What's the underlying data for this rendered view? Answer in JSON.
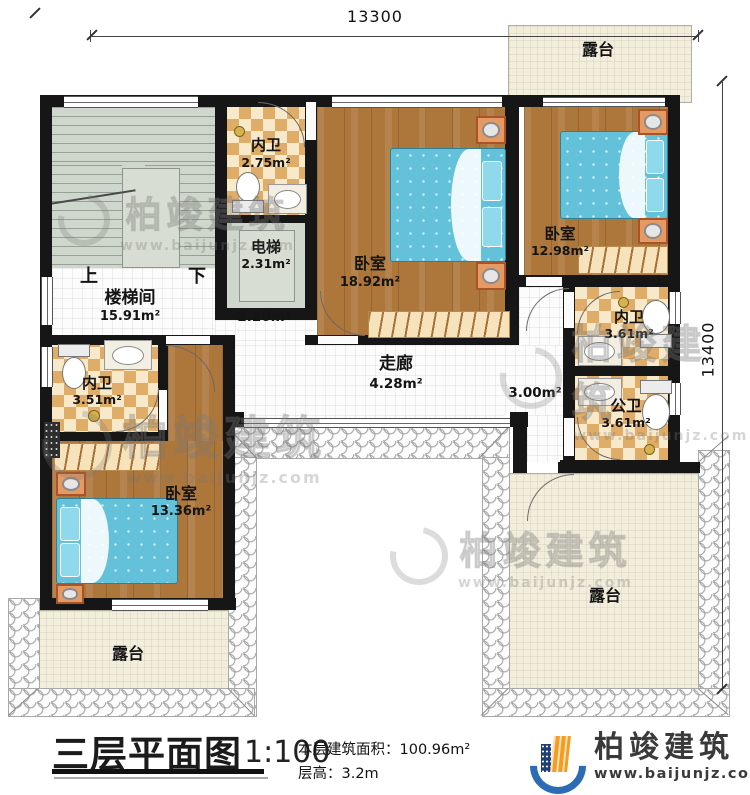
{
  "dimensions": {
    "top": "13300",
    "right": "13400"
  },
  "rooms": {
    "terrace_top": {
      "label": "露台"
    },
    "bath_top": {
      "label": "内卫",
      "area": "2.75m²"
    },
    "elevator": {
      "label": "电梯",
      "area": "2.31m²"
    },
    "bedroom_main": {
      "label": "卧室",
      "area": "18.92m²"
    },
    "bedroom_right": {
      "label": "卧室",
      "area": "12.98m²"
    },
    "stairwell": {
      "label": "楼梯间",
      "area": "15.91m²",
      "up": "上",
      "down": "下",
      "landing_area": "2.20m²"
    },
    "bath_right": {
      "label": "内卫",
      "area": "3.61m²"
    },
    "bath_public": {
      "label": "公卫",
      "area": "3.61m²"
    },
    "bath_left": {
      "label": "内卫",
      "area": "3.51m²"
    },
    "bedroom_left": {
      "label": "卧室",
      "area": "13.36m²"
    },
    "corridor": {
      "label": "走廊",
      "area": "4.28m²",
      "passage_area": "3.00m²"
    },
    "terrace_bottom_left": {
      "label": "露台"
    },
    "terrace_bottom_right": {
      "label": "露台"
    }
  },
  "title": {
    "name": "三层平面图",
    "scale": "1:100",
    "floor_area_label": "本层建筑面积：",
    "floor_area": "100.96m²",
    "height_label": "层高：",
    "height": "3.2m"
  },
  "brand": {
    "name": "柏竣建筑",
    "website": "www.baijunjz.com"
  },
  "watermark": {
    "name": "柏竣建筑",
    "website": "www.baijunjz.com"
  },
  "colors": {
    "wall": "#161616",
    "wood_floor": "#ad763a",
    "bath_tile": "#e0ad68",
    "terrace": "#f2eedb",
    "stair_floor": "#cfd6cb",
    "bed": "#63c2da",
    "brand_blue": "#2b6cb5",
    "brand_orange": "#f59d20"
  }
}
